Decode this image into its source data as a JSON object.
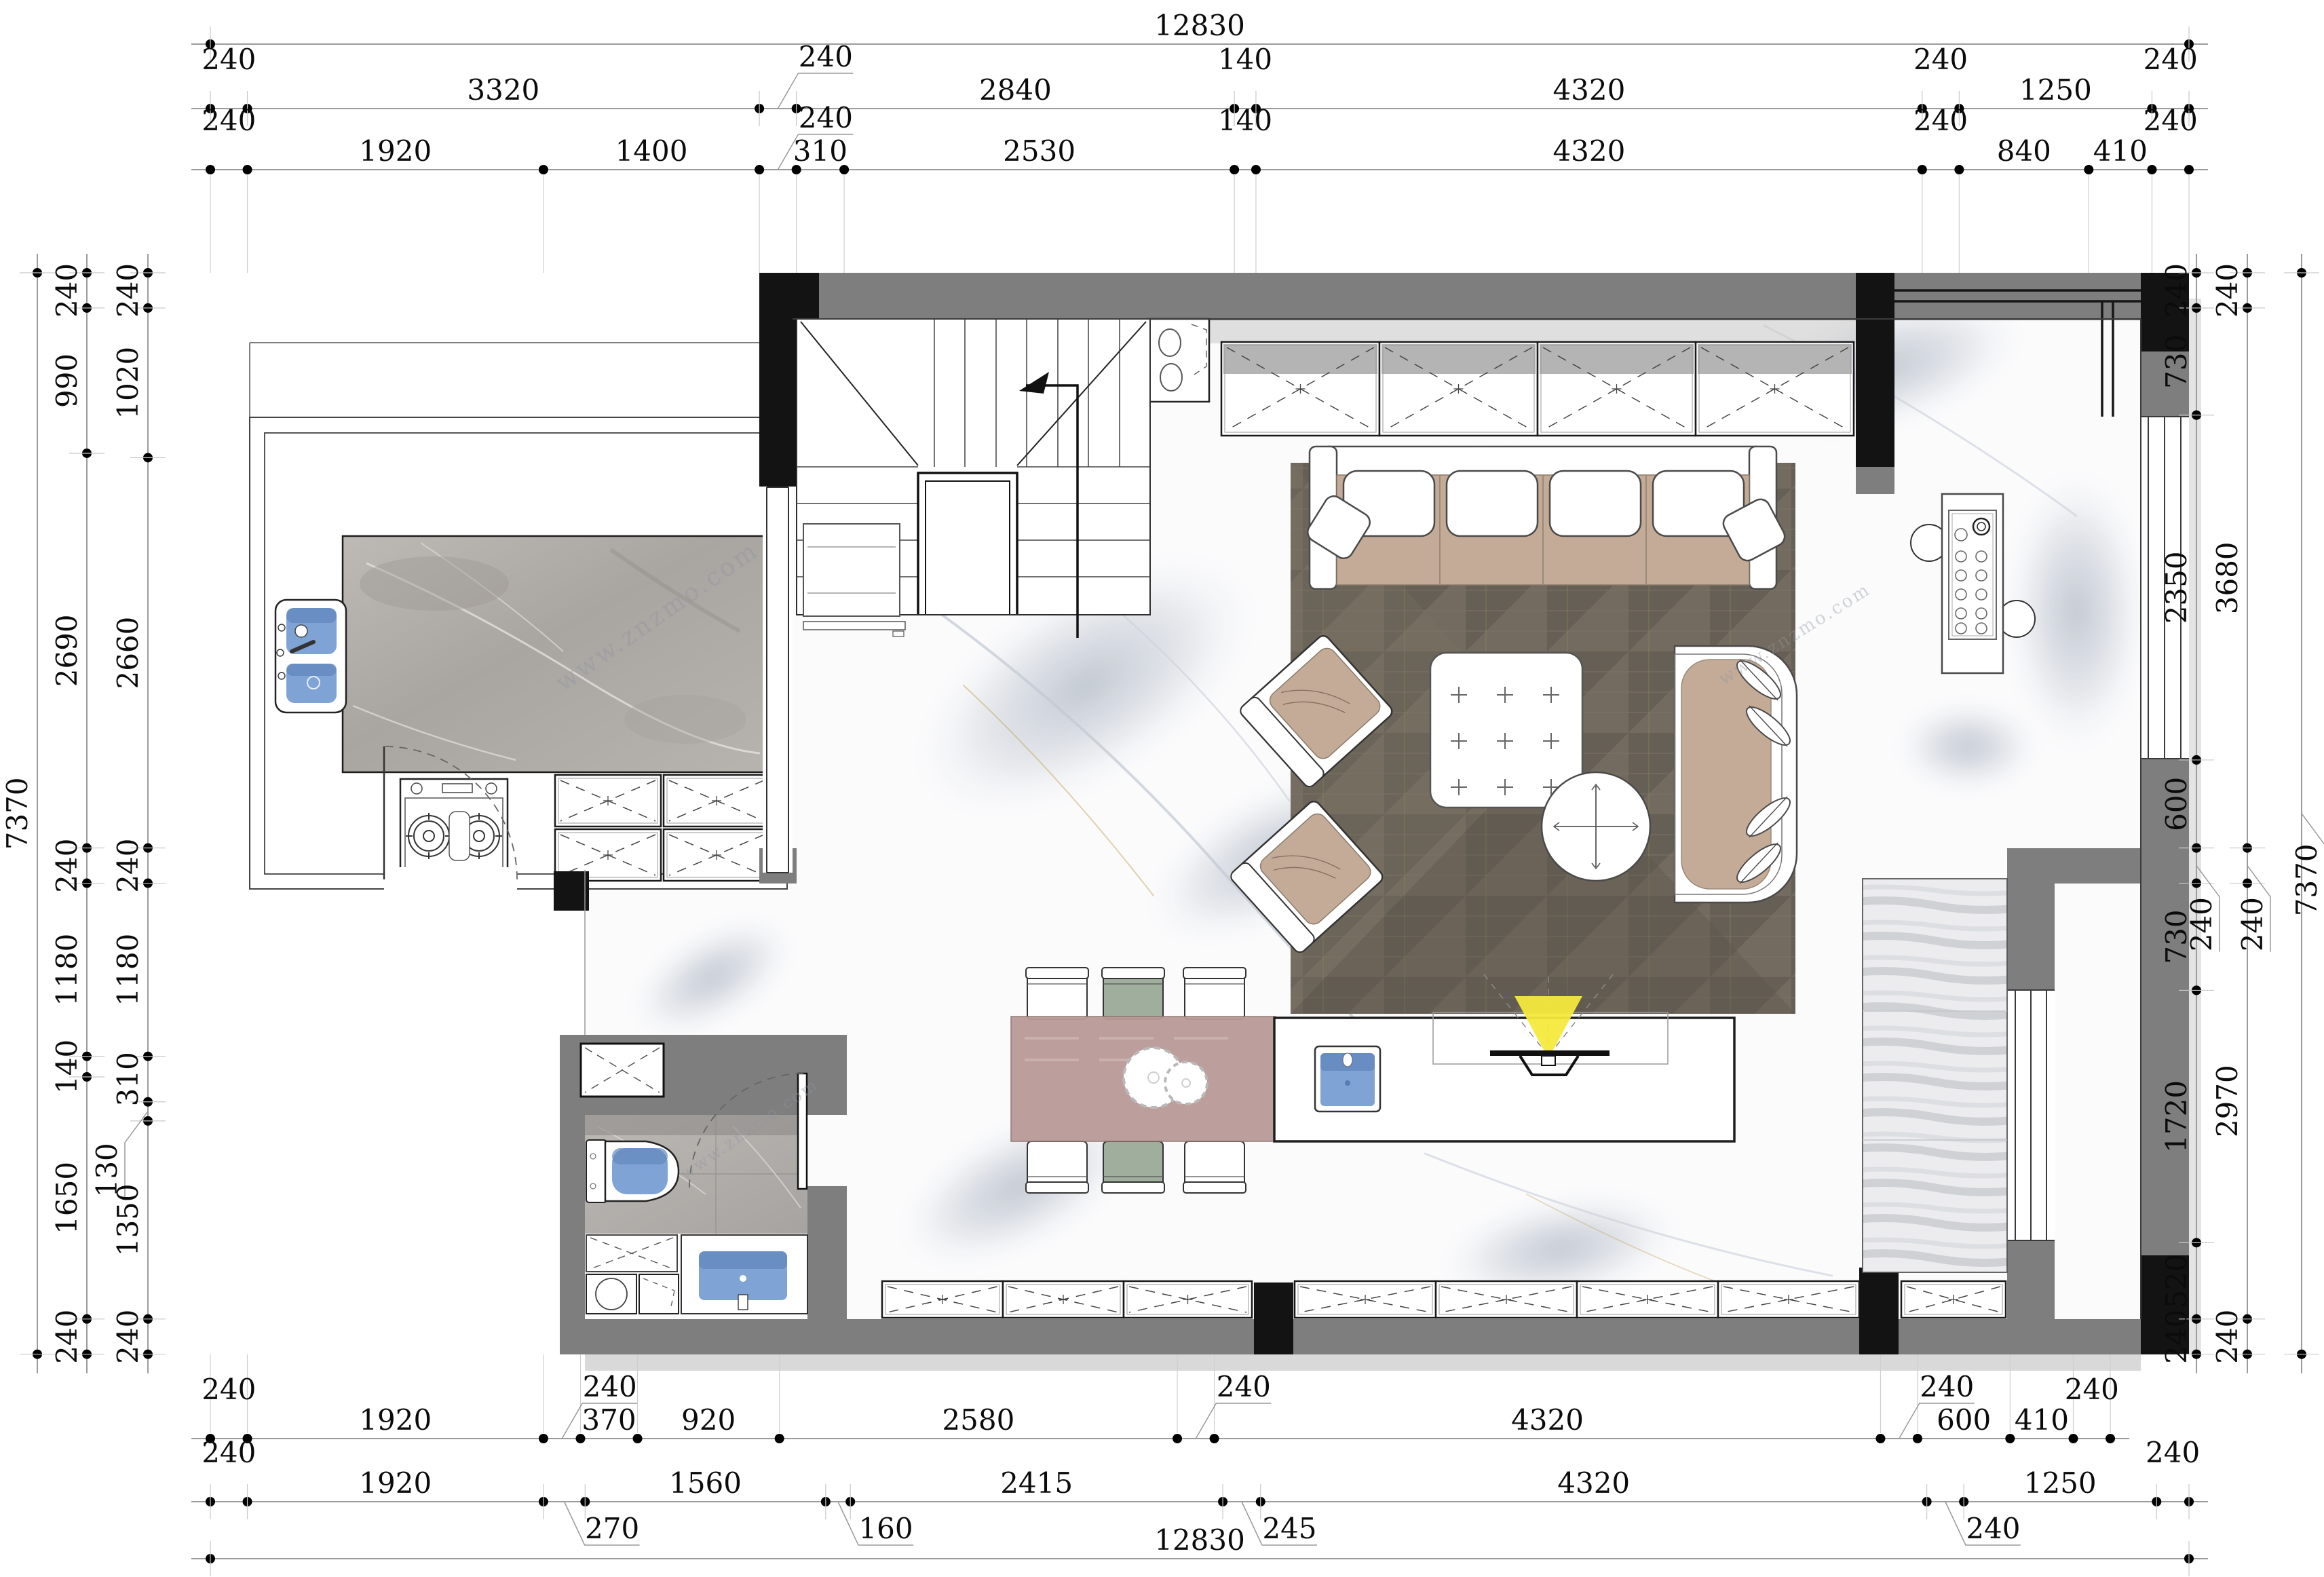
{
  "title": "residential-floor-plan",
  "watermark": "www.znzmo.com",
  "colors": {
    "wall_gray": "#7e7e7e",
    "wall_black": "#131313",
    "shadow_gray": "#c9c9c9",
    "rug": "#6f675d",
    "sofa_tan": "#c4ab97",
    "dining_table": "#b99a97",
    "chair_green": "#a0ae9e",
    "sink_blue": "#7fa3d4",
    "sink_blue_dark": "#6287bd",
    "light_yellow": "#f4e93c",
    "counter_marble": "#b3afab",
    "bath_marble": "#b5b1ad",
    "dim_line": "#9b9b9b",
    "dim_text": "#0b0b0b"
  },
  "dimensions": {
    "unit": "mm",
    "top": {
      "overall": {
        "v": "12830",
        "a": 0,
        "b": 12830
      },
      "row2": [
        {
          "v": "240",
          "a": 0,
          "b": 240,
          "m": "lift"
        },
        {
          "v": "3320",
          "a": 240,
          "b": 3560
        },
        {
          "v": "240",
          "a": 3560,
          "b": 3800,
          "m": "leader"
        },
        {
          "v": "2840",
          "a": 3800,
          "b": 6640
        },
        {
          "v": "140",
          "a": 6640,
          "b": 6780,
          "m": "lift"
        },
        {
          "v": "4320",
          "a": 6780,
          "b": 11100
        },
        {
          "v": "240",
          "a": 11100,
          "b": 11340,
          "m": "lift"
        },
        {
          "v": "1250",
          "a": 11340,
          "b": 12590
        },
        {
          "v": "240",
          "a": 12590,
          "b": 12830,
          "m": "lift"
        }
      ],
      "row3": [
        {
          "v": "240",
          "a": 0,
          "b": 240,
          "m": "lift"
        },
        {
          "v": "1920",
          "a": 240,
          "b": 2160
        },
        {
          "v": "1400",
          "a": 2160,
          "b": 3560
        },
        {
          "v": "240",
          "a": 3560,
          "b": 3800,
          "m": "leader"
        },
        {
          "v": "310",
          "a": 3800,
          "b": 4110
        },
        {
          "v": "2530",
          "a": 4110,
          "b": 6640
        },
        {
          "v": "140",
          "a": 6640,
          "b": 6780,
          "m": "lift"
        },
        {
          "v": "4320",
          "a": 6780,
          "b": 11100
        },
        {
          "v": "240",
          "a": 11100,
          "b": 11340,
          "m": "lift"
        },
        {
          "v": "840",
          "a": 11340,
          "b": 12180
        },
        {
          "v": "410",
          "a": 12180,
          "b": 12590
        },
        {
          "v": "240",
          "a": 12590,
          "b": 12830,
          "m": "lift"
        }
      ]
    },
    "bottom": {
      "row1": [
        {
          "v": "240",
          "a": 0,
          "b": 240,
          "m": "lift"
        },
        {
          "v": "1920",
          "a": 240,
          "b": 2160
        },
        {
          "v": "240",
          "a": 2160,
          "b": 2400,
          "m": "leader"
        },
        {
          "v": "370",
          "a": 2400,
          "b": 2770
        },
        {
          "v": "920",
          "a": 2770,
          "b": 3690
        },
        {
          "v": "2580",
          "a": 3690,
          "b": 6270
        },
        {
          "v": "240",
          "a": 6270,
          "b": 6510,
          "m": "leader"
        },
        {
          "v": "4320",
          "a": 6510,
          "b": 10830
        },
        {
          "v": "240",
          "a": 10830,
          "b": 11070,
          "m": "leader"
        },
        {
          "v": "600",
          "a": 11070,
          "b": 11670
        },
        {
          "v": "410",
          "a": 11670,
          "b": 12080
        },
        {
          "v": "240",
          "a": 12080,
          "b": 12320,
          "m": "lift"
        }
      ],
      "row2": [
        {
          "v": "240",
          "a": 0,
          "b": 240,
          "m": "lift"
        },
        {
          "v": "1920",
          "a": 240,
          "b": 2160
        },
        {
          "v": "270",
          "a": 2160,
          "b": 2430,
          "m": "leader"
        },
        {
          "v": "1560",
          "a": 2430,
          "b": 3990
        },
        {
          "v": "160",
          "a": 3990,
          "b": 4150,
          "m": "leader"
        },
        {
          "v": "2415",
          "a": 4150,
          "b": 6565
        },
        {
          "v": "245",
          "a": 6565,
          "b": 6810,
          "m": "leader"
        },
        {
          "v": "4320",
          "a": 6810,
          "b": 11130
        },
        {
          "v": "240",
          "a": 11130,
          "b": 11370,
          "m": "leader"
        },
        {
          "v": "1250",
          "a": 11370,
          "b": 12620
        },
        {
          "v": "240",
          "a": 12620,
          "b": 12830,
          "m": "lift"
        }
      ],
      "overall": {
        "v": "12830",
        "a": 0,
        "b": 12830
      }
    },
    "left": {
      "outer": {
        "v": "7370",
        "a": 0,
        "b": 7370
      },
      "mid": [
        {
          "v": "240",
          "a": 0,
          "b": 240
        },
        {
          "v": "990",
          "a": 240,
          "b": 1230
        },
        {
          "v": "2690",
          "a": 1230,
          "b": 3920
        },
        {
          "v": "240",
          "a": 3920,
          "b": 4160
        },
        {
          "v": "1180",
          "a": 4160,
          "b": 5340
        },
        {
          "v": "140",
          "a": 5340,
          "b": 5480
        },
        {
          "v": "1650",
          "a": 5480,
          "b": 7130
        },
        {
          "v": "240",
          "a": 7130,
          "b": 7370
        }
      ],
      "inner": [
        {
          "v": "240",
          "a": 0,
          "b": 240
        },
        {
          "v": "1020",
          "a": 240,
          "b": 1260
        },
        {
          "v": "2660",
          "a": 1260,
          "b": 3920
        },
        {
          "v": "240",
          "a": 3920,
          "b": 4160
        },
        {
          "v": "1180",
          "a": 4160,
          "b": 5340
        },
        {
          "v": "310",
          "a": 5340,
          "b": 5650
        },
        {
          "v": "130",
          "a": 5650,
          "b": 5780,
          "m": "leader"
        },
        {
          "v": "1350",
          "a": 5780,
          "b": 7130
        },
        {
          "v": "240",
          "a": 7130,
          "b": 7370
        }
      ]
    },
    "right": {
      "inner": [
        {
          "v": "240",
          "a": 0,
          "b": 240
        },
        {
          "v": "730",
          "a": 240,
          "b": 970
        },
        {
          "v": "2350",
          "a": 970,
          "b": 3320
        },
        {
          "v": "600",
          "a": 3320,
          "b": 3920
        },
        {
          "v": "240",
          "a": 3920,
          "b": 4160,
          "m": "leader"
        },
        {
          "v": "730",
          "a": 4160,
          "b": 4890
        },
        {
          "v": "1720",
          "a": 4890,
          "b": 6610
        },
        {
          "v": "520",
          "a": 6610,
          "b": 7130
        },
        {
          "v": "240",
          "a": 7130,
          "b": 7370
        }
      ],
      "mid": [
        {
          "v": "240",
          "a": 0,
          "b": 240
        },
        {
          "v": "3680",
          "a": 240,
          "b": 3920
        },
        {
          "v": "240",
          "a": 3920,
          "b": 4160,
          "m": "leader"
        },
        {
          "v": "2970",
          "a": 4160,
          "b": 7130
        },
        {
          "v": "240",
          "a": 7130,
          "b": 7370
        }
      ],
      "outer": {
        "v": "7370",
        "a": 0,
        "b": 7370,
        "m": "leader"
      }
    }
  }
}
